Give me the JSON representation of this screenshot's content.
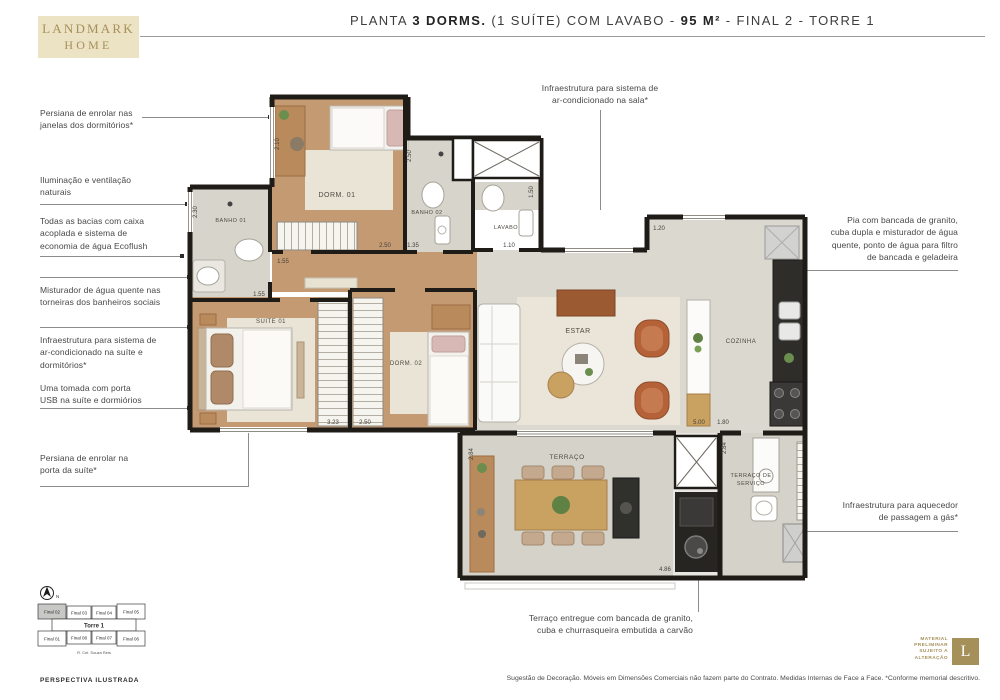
{
  "colors": {
    "brand_gold": "#a6905a",
    "logo_bg": "#ece2c4",
    "wall": "#1f1c18",
    "wood_floor": "#c49a73",
    "tile_floor": "#d6d4cb",
    "accent_terracotta": "#b56238"
  },
  "header": {
    "logo_line1": "LANDMARK",
    "logo_line2": "HOME",
    "title": {
      "prefix": "PLANTA ",
      "bold1": "3 DORMS.",
      "mid": " (1 SUÍTE) COM LAVABO - ",
      "bold2": "95 M²",
      "suffix": " - FINAL 2 - TORRE 1"
    }
  },
  "annotations": {
    "left1": "Persiana de enrolar nas\njanelas dos dormitórios*",
    "left2": "Iluminação e ventilação\nnaturais",
    "left3": "Todas as bacias com caixa\nacoplada e sistema de\neconomia de água Ecoflush",
    "left4": "Misturador de água quente nas\ntorneiras dos banheiros sociais",
    "left5": "Infraestrutura para sistema de\nar-condicionado na suíte e\ndormitórios*",
    "left6": "Uma tomada com porta\nUSB na suíte e dormiórios",
    "left7": "Persiana de enrolar na\nporta da suíte*",
    "top": "Infraestrutura para sistema de\nar-condicionado na sala*",
    "right1": "Pia com bancada de granito,\ncuba dupla e misturador de água\nquente, ponto de água para filtro\nde bancada e geladeira",
    "right2": "Infraestrutura para aquecedor\nde passagem a gás*",
    "bottom": "Terraço entregue com bancada de granito,\ncuba e churrasqueira embutida a carvão"
  },
  "plan": {
    "rooms": {
      "dorm01": "DORM. 01",
      "banho02": "BANHO 02",
      "lavabo": "LAVABO",
      "banho01": "BANHO 01",
      "suite01": "SUITE 01",
      "dorm02": "DORM. 02",
      "estar": "ESTAR",
      "cozinha": "COZINHA",
      "terraco": "TERRAÇO",
      "servico_l1": "TERRAÇO DE",
      "servico_l2": "SERVIÇO"
    },
    "dims": {
      "d210": "2.10",
      "d230": "2.30",
      "d250a": "2.50",
      "d250b": "2.50",
      "d250c": "2.50",
      "d135": "1.35",
      "d150": "1.50",
      "d110": "1.10",
      "d155a": "1.55",
      "d155b": "1.55",
      "d120": "1.20",
      "d323": "3.23",
      "d500": "5.00",
      "d180": "1.80",
      "d486": "4.86",
      "d284a": "2.84",
      "d284b": "2.84"
    }
  },
  "keyplan": {
    "north": "N",
    "torre": "Torre 1",
    "street": "R. Cel. Souza Reis",
    "row_top": [
      "Final 02",
      "Final 03",
      "Final 04",
      "Final 05"
    ],
    "row_bottom": [
      "Final 01",
      "Final 08",
      "Final 07",
      "Final 06"
    ],
    "highlighted_unit": "Final 02"
  },
  "footer": {
    "perspectiva": "PERSPECTIVA ILUSTRADA",
    "disclaimer": "Sugestão de Decoração. Móveis em Dimensões Comerciais não fazem parte do Contrato. Medidas Internas de Face a Face. *Conforme memorial descritivo.",
    "material_note": "MATERIAL\nPRELIMINAR\nSUJEITO A\nALTERAÇÃO",
    "logo_letter": "L"
  }
}
